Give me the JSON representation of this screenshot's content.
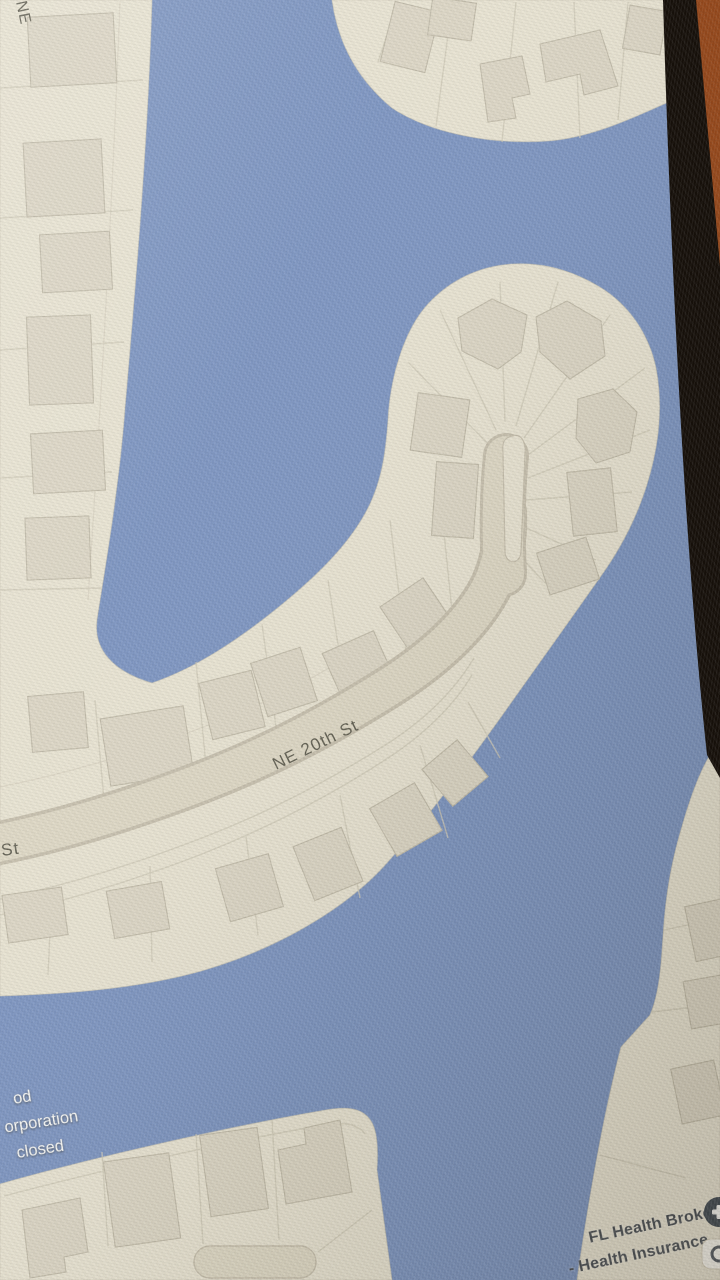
{
  "map": {
    "street_labels": [
      {
        "id": "ne-20th-st",
        "text": "NE 20th St"
      },
      {
        "id": "st-partial",
        "text": "St"
      },
      {
        "id": "ne-partial",
        "text": "NE"
      }
    ],
    "poi_labels": [
      {
        "id": "closed-business",
        "lines": [
          "od",
          "orporation",
          "closed"
        ]
      },
      {
        "id": "fl-health-brokers",
        "lines": [
          "FL Health Brokers",
          "- Health Insurance…"
        ]
      }
    ],
    "icons": [
      {
        "name": "poi-pin-icon"
      },
      {
        "name": "poi-badge-icon"
      }
    ]
  },
  "colors": {
    "water": "#7d95c1",
    "land": "#e8e3d2",
    "landEdge": "#c9c2b0",
    "building": "#dcd6c5",
    "buildingStroke": "#c2bcaa",
    "parcel": "#cfc9b7",
    "streetFill": "#ded8c5",
    "streetEdge": "#c7c0ae",
    "streetText": "#615f52",
    "labelWhite": "#fcfcf9",
    "labelDark": "#494e54",
    "pin": "#424b54",
    "badgeBg": "#f8f6ef",
    "badgeGlyph": "#565c64",
    "bezel": "#16100a",
    "backdrop": "#94481c"
  }
}
